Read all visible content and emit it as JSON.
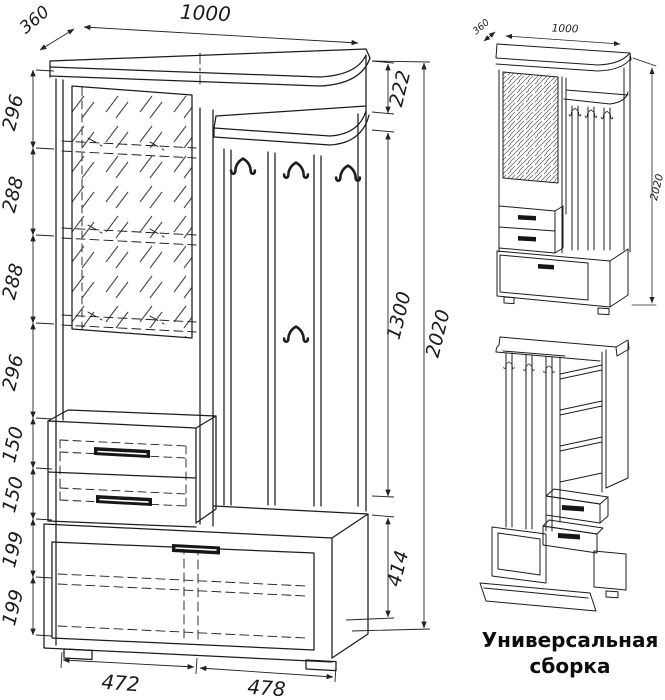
{
  "drawing": {
    "main_view": {
      "top_width": "1000",
      "top_depth": "360",
      "left_chain": [
        "296",
        "288",
        "288",
        "296",
        "150",
        "150",
        "199",
        "199"
      ],
      "right_chain": {
        "top_shelf": "222",
        "hook_panel": "1300",
        "cabinet": "414"
      },
      "total_height": "2020",
      "bottom_left_width": "472",
      "bottom_right_width": "478"
    },
    "assembly_view": {
      "depth": "360",
      "width": "1000",
      "height": "2020",
      "caption_line1": "Универсальная",
      "caption_line2": "сборка"
    },
    "icons": {
      "coat_hook": "double-prong-coat-hook"
    },
    "colors": {
      "line": "#1c1c1c",
      "dim": "#222222",
      "background": "#ffffff"
    }
  }
}
